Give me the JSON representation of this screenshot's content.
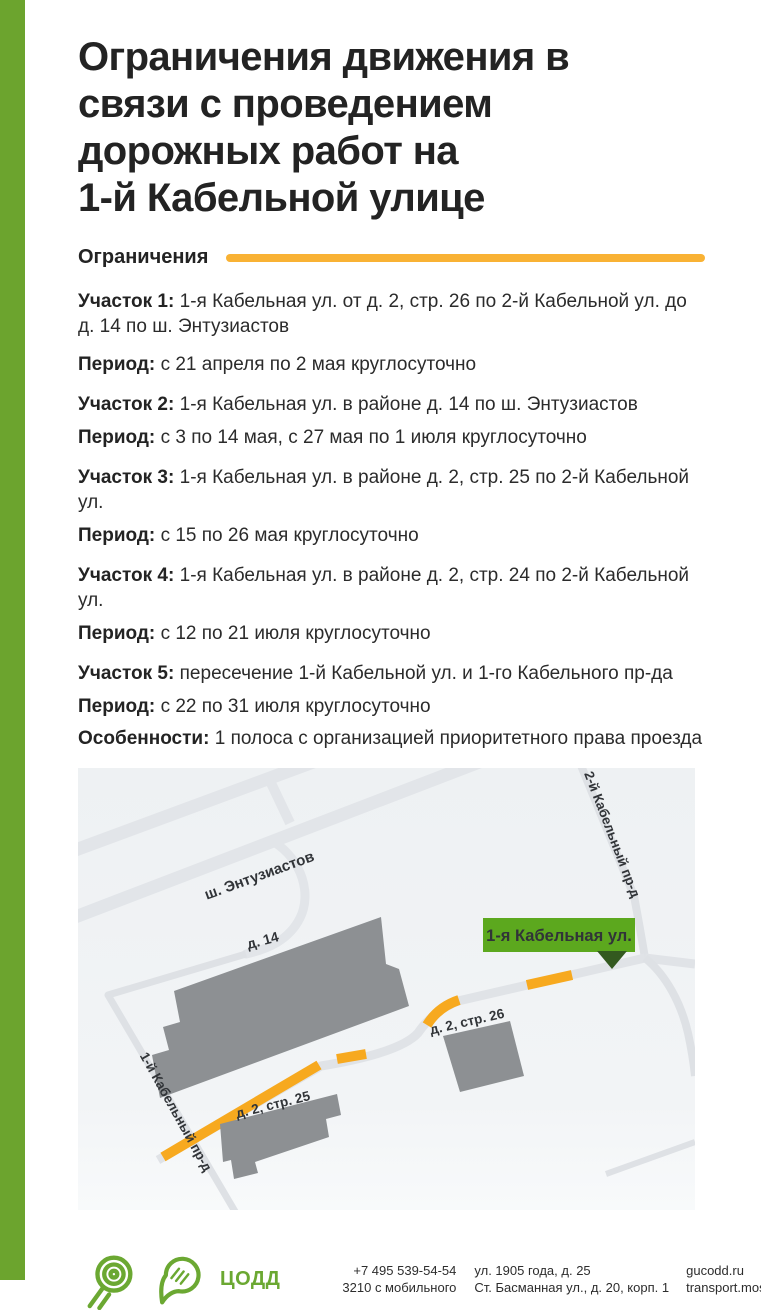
{
  "page": {
    "accent_green": "#6CA42E",
    "accent_yellow": "#F9B234",
    "road_orange": "#F7A91F",
    "building_gray": "#8D9093",
    "callout_green": "#5CA81E",
    "callout_pointer_green": "#33591F"
  },
  "header": {
    "title_lines": [
      "Ограничения движения в",
      "связи с проведением",
      "дорожных работ на",
      "1-й Кабельной улице"
    ]
  },
  "restrictions": {
    "section_label": "Ограничения",
    "items": [
      {
        "lead": "Участок 1:",
        "text": "1-я Кабельная ул. от д. 2, стр. 26 по 2-й Кабельной ул. до д. 14 по ш. Энтузиастов"
      },
      {
        "lead": "Период:",
        "text": "с 21 апреля по 2 мая круглосуточно"
      },
      {
        "lead": "Участок 2:",
        "text": "1-я Кабельная ул. в районе д. 14 по ш. Энтузиастов"
      },
      {
        "lead": "Период:",
        "text": "с 3 по 14 мая, с 27 мая по 1 июля круглосуточно"
      },
      {
        "lead": "Участок 3:",
        "text": "1-я Кабельная ул. в районе д. 2, стр. 25 по 2-й Кабельной ул."
      },
      {
        "lead": "Период:",
        "text": "с 15 по 26 мая круглосуточно"
      },
      {
        "lead": "Участок 4:",
        "text": "1-я Кабельная ул. в районе д. 2, стр. 24 по 2-й Кабельной ул."
      },
      {
        "lead": "Период:",
        "text": "с 12 по 21 июля круглосуточно"
      },
      {
        "lead": "Участок 5:",
        "text": "пересечение 1-й Кабельной ул. и 1-го Кабельного пр-да"
      },
      {
        "lead": "Период:",
        "text": "с 22 по 31 июля круглосуточно"
      },
      {
        "lead": "Особенности:",
        "text": "1 полоса с организацией приоритетного права проезда"
      }
    ]
  },
  "map": {
    "callout": "1-я Кабельная ул.",
    "labels": {
      "highway": "ш. Энтузиастов",
      "street2": "2-й Кабельный пр-д",
      "street1": "1-й Кабельный пр-д",
      "b14": "д. 14",
      "b25": "д. 2, стр. 25",
      "b26": "д. 2, стр. 26"
    }
  },
  "footer": {
    "org": "ЦОДД",
    "phone1": "+7 495 539-54-54",
    "phone2": "3210 с мобильного",
    "addr1": "ул. 1905 года, д. 25",
    "addr2": "Ст. Басманная ул., д. 20, корп. 1",
    "link1": "gucodd.ru",
    "link2": "transport.mos.ru"
  }
}
